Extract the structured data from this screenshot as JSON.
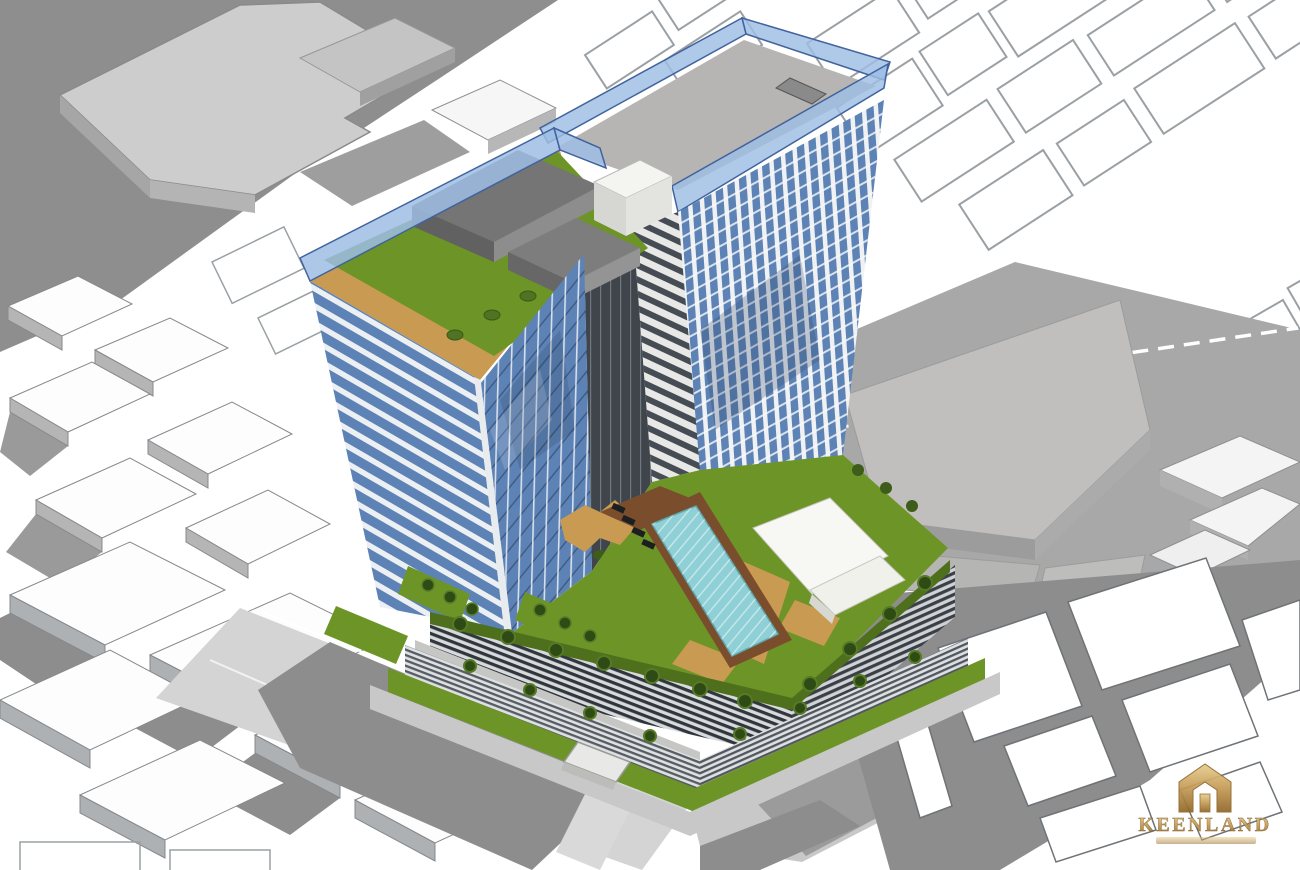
{
  "scene": {
    "type": "3d-architectural-massing-render",
    "elements": [
      "left residential tower with rooftop lawn garden",
      "right residential tower with glass parapet roof",
      "rooftop mechanical boxes",
      "podium roof deck with lap pool",
      "pool sun deck and white canopy",
      "planter terraces with shrubs",
      "louvered podium facade",
      "street level lawn verges and sidewalks",
      "surrounding low-rise white blocks with cast shadows",
      "cadastral parcel outlines",
      "road with dashed lane markings"
    ]
  },
  "watermark": {
    "wordmark": "KEENLAND",
    "icon": "house-monogram-icon"
  },
  "palette": {
    "background": "#ffffff",
    "parcel_outline": "#9aa0a4",
    "shadow": "#8d8d8d",
    "building_side": "#b3b3b3",
    "building_top": "#fdfdfd",
    "road": "#a8a8a8",
    "plaza": "#c0bfbd",
    "glass_blue": "#5d83b6",
    "parapet_blue": "#9dbde4",
    "slab_white": "#eef1f4",
    "dark_louver": "#30363c",
    "grass": "#6d9427",
    "grass_dark": "#4e701d",
    "bush_green": "#2f4b15",
    "deck_tan": "#c89a52",
    "pool_water": "#8fd0d6",
    "pool_deck_brown": "#7a4e2c",
    "mech_gray": "#7d7d7d",
    "canopy_white": "#f7f7f4",
    "logo_gold": "#b08947"
  }
}
